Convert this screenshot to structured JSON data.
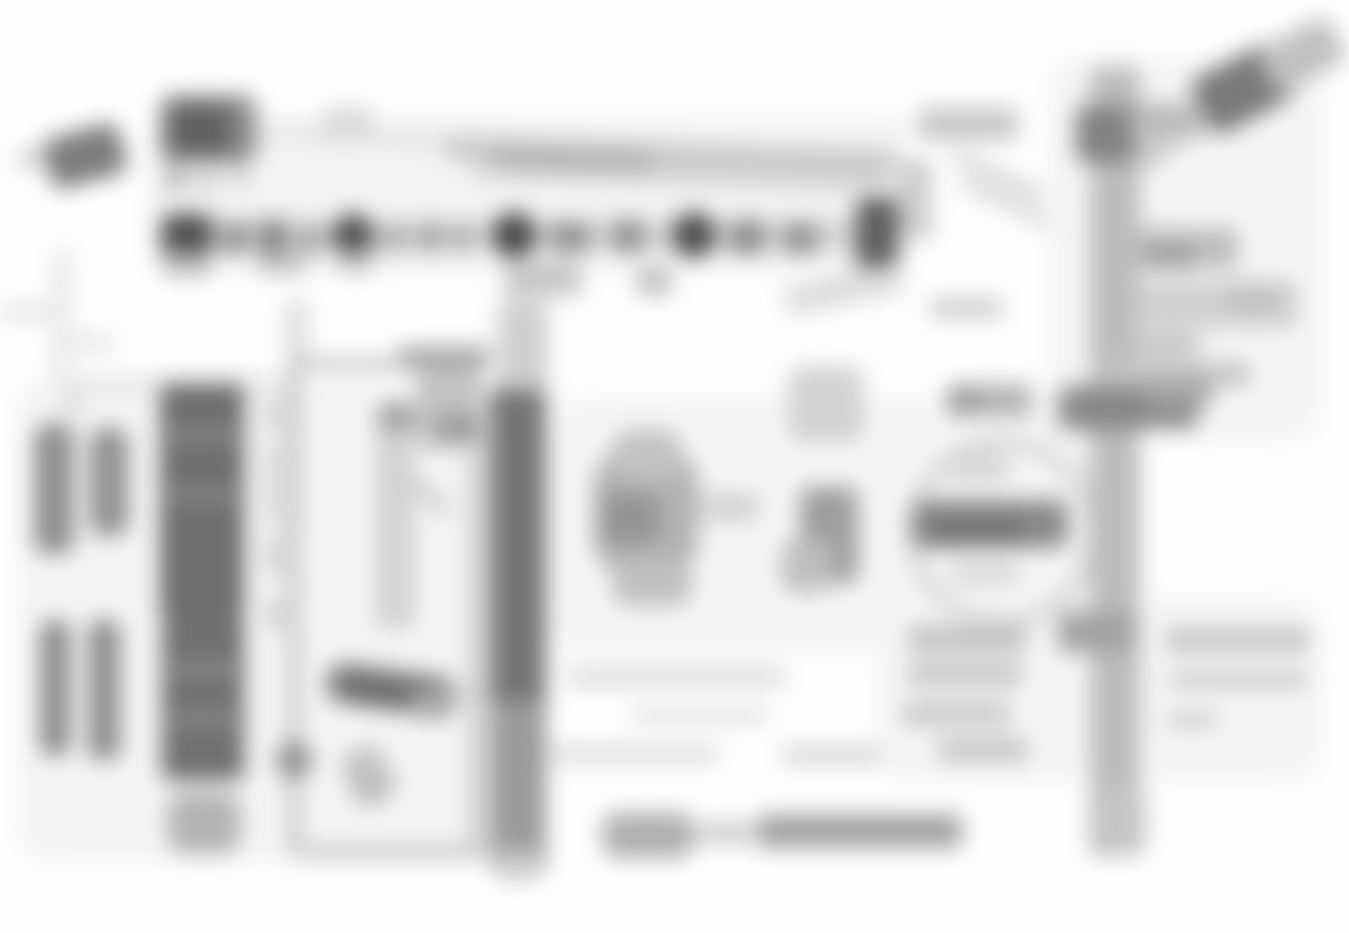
{
  "figure": {
    "type": "wiring-diagram",
    "appearance": "heavily-blurred grayscale schematic, no legible text",
    "background": "#fefefe",
    "blur_px": 11,
    "canvas": {
      "width": 1349,
      "height": 933
    }
  },
  "diagram": {
    "washes": [
      [
        150,
        120,
        760,
        150,
        "#f2f2f2",
        20,
        0
      ],
      [
        20,
        380,
        500,
        480,
        "#f3f3f3",
        30,
        0
      ],
      [
        550,
        400,
        560,
        250,
        "#f4f4f4",
        30,
        0
      ],
      [
        880,
        600,
        440,
        180,
        "#f4f4f4",
        30,
        0
      ],
      [
        1050,
        60,
        270,
        380,
        "#f4f4f4",
        30,
        0
      ]
    ],
    "blobs": [
      [
        46,
        130,
        78,
        52,
        "#7d7d7d",
        12,
        -15
      ],
      [
        18,
        150,
        30,
        16,
        "#c8c8c8",
        6,
        -15
      ],
      [
        160,
        95,
        96,
        68,
        "#8a8a8a",
        14,
        0
      ],
      [
        170,
        105,
        60,
        48,
        "#616161",
        10,
        0
      ],
      [
        166,
        168,
        20,
        22,
        "#b0b0b0",
        4,
        0
      ],
      [
        200,
        170,
        14,
        18,
        "#b8b8b8",
        4,
        0
      ],
      [
        232,
        168,
        14,
        16,
        "#c0c0c0",
        4,
        0
      ],
      [
        322,
        108,
        52,
        36,
        "#d6d6d6",
        10,
        0
      ],
      [
        256,
        128,
        200,
        14,
        "#e2e2e2",
        6,
        4
      ],
      [
        446,
        143,
        450,
        24,
        "#c9c9c9",
        8,
        2
      ],
      [
        470,
        168,
        420,
        16,
        "#d4d4d4",
        8,
        2
      ],
      [
        492,
        150,
        160,
        20,
        "#b2b2b2",
        8,
        2
      ],
      [
        158,
        222,
        740,
        26,
        "#d2d2d2",
        6,
        0
      ],
      [
        162,
        214,
        50,
        44,
        "#4f4f4f",
        8,
        0
      ],
      [
        222,
        222,
        26,
        32,
        "#8f8f8f",
        4,
        0
      ],
      [
        258,
        220,
        30,
        36,
        "#858585",
        4,
        0
      ],
      [
        300,
        224,
        20,
        30,
        "#a0a0a0",
        4,
        0
      ],
      [
        332,
        214,
        42,
        44,
        "#4f4f4f",
        "50%",
        0
      ],
      [
        386,
        224,
        18,
        28,
        "#a0a0a0",
        4,
        0
      ],
      [
        420,
        222,
        20,
        30,
        "#9a9a9a",
        4,
        0
      ],
      [
        453,
        224,
        18,
        28,
        "#a5a5a5",
        4,
        0
      ],
      [
        492,
        212,
        44,
        46,
        "#4a4a4a",
        "50%",
        0
      ],
      [
        550,
        222,
        40,
        30,
        "#909090",
        4,
        0
      ],
      [
        612,
        220,
        32,
        32,
        "#8f8f8f",
        6,
        0
      ],
      [
        672,
        212,
        44,
        46,
        "#4f4f4f",
        "50%",
        0
      ],
      [
        730,
        220,
        34,
        34,
        "#8a8a8a",
        6,
        0
      ],
      [
        782,
        222,
        36,
        32,
        "#959595",
        4,
        0
      ],
      [
        856,
        198,
        42,
        70,
        "#5f5f5f",
        8,
        0
      ],
      [
        163,
        252,
        48,
        24,
        "#bababa",
        6,
        0
      ],
      [
        258,
        254,
        48,
        20,
        "#c2c2c2",
        6,
        0
      ],
      [
        337,
        250,
        36,
        22,
        "#bdbdbd",
        6,
        0
      ],
      [
        504,
        262,
        78,
        34,
        "#c6c6c6",
        10,
        0
      ],
      [
        636,
        266,
        36,
        30,
        "#c3c3c3",
        8,
        0
      ],
      [
        55,
        248,
        14,
        136,
        "#e3e3e3",
        8,
        0
      ],
      [
        60,
        376,
        240,
        14,
        "#e3e3e3",
        8,
        0
      ],
      [
        60,
        396,
        24,
        18,
        "#dadada",
        6,
        0
      ],
      [
        0,
        304,
        70,
        16,
        "#e4e4e4",
        6,
        0
      ],
      [
        62,
        336,
        52,
        14,
        "#e2e2e2",
        6,
        0
      ],
      [
        286,
        300,
        22,
        60,
        "#dcdcdc",
        8,
        0
      ],
      [
        288,
        358,
        196,
        12,
        "#c4c4c4",
        6,
        0
      ],
      [
        288,
        358,
        12,
        500,
        "#c4c4c4",
        6,
        0
      ],
      [
        470,
        358,
        12,
        500,
        "#c4c4c4",
        6,
        0
      ],
      [
        300,
        846,
        184,
        12,
        "#c4c4c4",
        6,
        0
      ],
      [
        398,
        346,
        92,
        22,
        "#a8a8a8",
        6,
        0
      ],
      [
        376,
        402,
        38,
        226,
        "#d2d2d2",
        8,
        0
      ],
      [
        380,
        404,
        34,
        26,
        "#9e9e9e",
        6,
        0
      ],
      [
        416,
        370,
        56,
        78,
        "#c2c2c2",
        10,
        0
      ],
      [
        436,
        414,
        46,
        28,
        "#9c9c9c",
        8,
        0
      ],
      [
        396,
        486,
        60,
        14,
        "#cfcfcf",
        6,
        40
      ],
      [
        326,
        670,
        132,
        40,
        "#7a7a7a",
        20,
        8
      ],
      [
        350,
        684,
        90,
        24,
        "#6d6d6d",
        12,
        8
      ],
      [
        276,
        742,
        36,
        36,
        "#8f8f8f",
        "50%",
        0
      ],
      [
        348,
        748,
        40,
        56,
        "#bcbcbc",
        12,
        -20
      ],
      [
        264,
        400,
        28,
        28,
        "#d6d6d6",
        6,
        0
      ],
      [
        264,
        440,
        20,
        86,
        "#dcdcdc",
        6,
        0
      ],
      [
        264,
        538,
        30,
        36,
        "#d6d6d6",
        6,
        0
      ],
      [
        264,
        598,
        30,
        32,
        "#d8d8d8",
        6,
        0
      ],
      [
        410,
        690,
        90,
        12,
        "#cdcdcd",
        6,
        -8
      ],
      [
        348,
        762,
        54,
        12,
        "#c6c6c6",
        6,
        35
      ],
      [
        160,
        384,
        84,
        236,
        "#6e6e6e",
        8,
        0
      ],
      [
        166,
        430,
        72,
        10,
        "#949494",
        4,
        0
      ],
      [
        166,
        490,
        72,
        10,
        "#949494",
        4,
        0
      ],
      [
        162,
        620,
        82,
        160,
        "#707070",
        8,
        0
      ],
      [
        168,
        664,
        70,
        10,
        "#969696",
        4,
        0
      ],
      [
        168,
        714,
        70,
        10,
        "#969696",
        4,
        0
      ],
      [
        168,
        792,
        72,
        62,
        "#b4b4b4",
        16,
        0
      ],
      [
        34,
        424,
        40,
        130,
        "#8f8f8f",
        14,
        0
      ],
      [
        90,
        428,
        38,
        108,
        "#919191",
        14,
        0
      ],
      [
        40,
        620,
        30,
        136,
        "#8c8c8c",
        12,
        0
      ],
      [
        88,
        620,
        32,
        140,
        "#8e8e8e",
        12,
        0
      ],
      [
        490,
        388,
        56,
        330,
        "#757575",
        6,
        0
      ],
      [
        490,
        700,
        56,
        170,
        "#9a9a9a",
        6,
        0
      ],
      [
        496,
        850,
        44,
        30,
        "#cccccc",
        8,
        0
      ],
      [
        498,
        300,
        50,
        90,
        "#cfcfcf",
        10,
        0
      ],
      [
        594,
        452,
        104,
        120,
        "#b2b2b2",
        30,
        0
      ],
      [
        612,
        430,
        70,
        50,
        "#c2c2c2",
        20,
        0
      ],
      [
        600,
        492,
        60,
        52,
        "#949494",
        16,
        0
      ],
      [
        612,
        560,
        80,
        46,
        "#c0c0c0",
        18,
        0
      ],
      [
        700,
        492,
        60,
        30,
        "#d5d5d5",
        10,
        0
      ],
      [
        800,
        487,
        58,
        96,
        "#9e9e9e",
        10,
        0
      ],
      [
        782,
        540,
        50,
        52,
        "#bebebe",
        12,
        0
      ],
      [
        788,
        366,
        76,
        76,
        "#d2d2d2",
        16,
        0
      ],
      [
        784,
        274,
        120,
        30,
        "#dcdcdc",
        10,
        -12
      ],
      [
        906,
        436,
        168,
        168,
        "#d4d4d4",
        "50%",
        0,
        "ring"
      ],
      [
        912,
        500,
        156,
        48,
        "#8a8a8a",
        12,
        0
      ],
      [
        928,
        516,
        96,
        28,
        "#757575",
        10,
        0
      ],
      [
        946,
        452,
        64,
        30,
        "#d8d8d8",
        10,
        0
      ],
      [
        950,
        560,
        70,
        26,
        "#dcdcdc",
        10,
        0
      ],
      [
        918,
        108,
        100,
        32,
        "#c6c6c6",
        8,
        0
      ],
      [
        948,
        170,
        100,
        12,
        "#cdcdcd",
        6,
        25
      ],
      [
        958,
        196,
        96,
        12,
        "#d2d2d2",
        6,
        25
      ],
      [
        898,
        160,
        34,
        80,
        "#cdcdcd",
        8,
        0
      ],
      [
        930,
        298,
        72,
        20,
        "#cdcdcd",
        6,
        0
      ],
      [
        946,
        384,
        86,
        32,
        "#b2b2b2",
        8,
        0
      ],
      [
        950,
        390,
        30,
        22,
        "#9a9a9a",
        6,
        0
      ],
      [
        1090,
        66,
        50,
        790,
        "#bcbcbc",
        8,
        0
      ],
      [
        1076,
        106,
        60,
        56,
        "#828282",
        8,
        0
      ],
      [
        1058,
        386,
        88,
        44,
        "#909090",
        8,
        0
      ],
      [
        1058,
        612,
        76,
        40,
        "#a2a2a2",
        8,
        0
      ],
      [
        1104,
        788,
        42,
        66,
        "#c6c6c6",
        10,
        0
      ],
      [
        1130,
        104,
        70,
        36,
        "#b2b2b2",
        8,
        0
      ],
      [
        1196,
        58,
        92,
        62,
        "#7a7a7a",
        12,
        -28
      ],
      [
        1262,
        30,
        80,
        50,
        "#c0c0c0",
        12,
        -28
      ],
      [
        1130,
        112,
        74,
        26,
        "#bbbbbb",
        8,
        -12
      ],
      [
        1134,
        138,
        40,
        26,
        "#cccccc",
        8,
        -35
      ],
      [
        1138,
        228,
        100,
        40,
        "#bdbdbd",
        8,
        0
      ],
      [
        1146,
        246,
        48,
        22,
        "#9a9a9a",
        6,
        0
      ],
      [
        1142,
        280,
        156,
        48,
        "#d0d0d0",
        10,
        0
      ],
      [
        1228,
        288,
        50,
        24,
        "#c0c0c0",
        8,
        0
      ],
      [
        1134,
        332,
        66,
        26,
        "#c8c8c8",
        8,
        0
      ],
      [
        1100,
        362,
        150,
        24,
        "#c4c4c4",
        8,
        0
      ],
      [
        1074,
        386,
        124,
        42,
        "#888888",
        8,
        0
      ],
      [
        1144,
        378,
        68,
        28,
        "#a6a6a6",
        8,
        0
      ],
      [
        908,
        626,
        118,
        26,
        "#c2c2c2",
        6,
        0
      ],
      [
        908,
        662,
        114,
        24,
        "#c6c6c6",
        6,
        0
      ],
      [
        902,
        702,
        108,
        24,
        "#cacaca",
        6,
        0
      ],
      [
        938,
        738,
        90,
        24,
        "#c6c6c6",
        6,
        0
      ],
      [
        1166,
        628,
        144,
        24,
        "#c6c6c6",
        6,
        0
      ],
      [
        1168,
        672,
        142,
        16,
        "#cccccc",
        6,
        0
      ],
      [
        1166,
        712,
        52,
        16,
        "#d0d0d0",
        6,
        0
      ],
      [
        758,
        814,
        204,
        34,
        "#a2a2a2",
        10,
        0
      ],
      [
        696,
        822,
        64,
        22,
        "#cfcfcf",
        8,
        0
      ],
      [
        602,
        812,
        92,
        46,
        "#b0b0b0",
        16,
        0
      ],
      [
        566,
        668,
        220,
        18,
        "#dadada",
        8,
        0
      ],
      [
        632,
        708,
        136,
        14,
        "#dedede",
        6,
        0
      ],
      [
        550,
        746,
        168,
        16,
        "#dadada",
        6,
        0
      ],
      [
        782,
        746,
        102,
        18,
        "#d6d6d6",
        6,
        0
      ]
    ]
  }
}
